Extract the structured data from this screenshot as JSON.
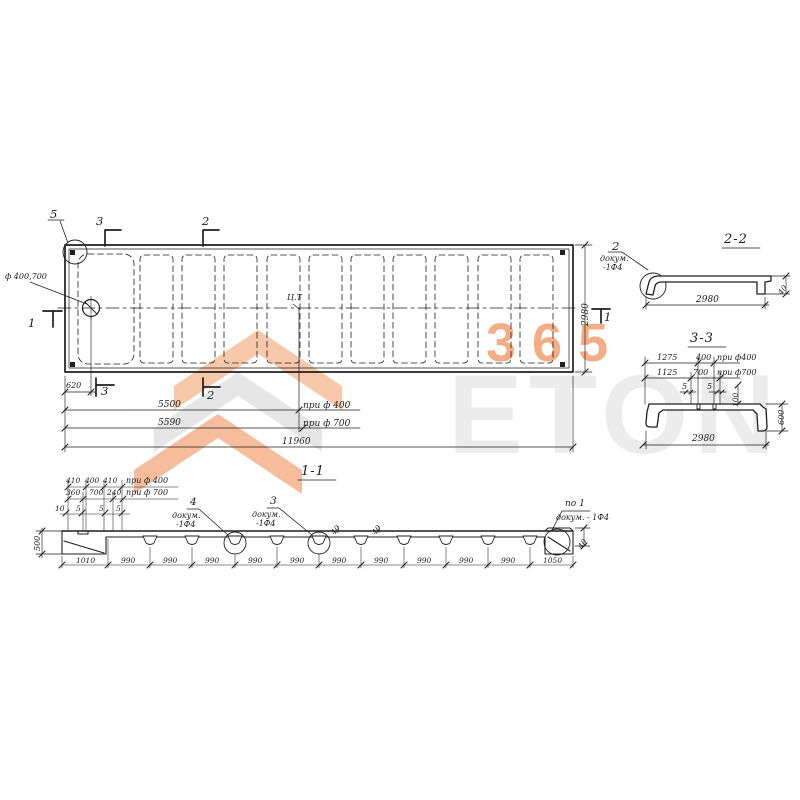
{
  "watermark": {
    "big_text": "ETON",
    "accent_text": "365",
    "accent_color": "#ee7b3a",
    "gray_color": "#ececec"
  },
  "plan": {
    "detail_callout": "5",
    "hole_label": "ф 400,700",
    "cg_label": "Ц.Т",
    "section_marks": {
      "m1_left": "1",
      "m1_right": "1",
      "m2_top": "2",
      "m2_bottom": "2",
      "m3_top": "3",
      "m3_bottom": "3"
    },
    "dims": {
      "hole_offset": "620",
      "to_cg_400": "5500",
      "to_cg_700": "5590",
      "length": "11960",
      "width": "2980",
      "note_400": "при ф 400",
      "note_700": "при ф 700"
    }
  },
  "section_2_2": {
    "title": "2-2",
    "callout": {
      "num": "2",
      "line1": "докум.",
      "line2": "-1Ф4"
    },
    "dims": {
      "width": "2980",
      "flange": "40"
    }
  },
  "section_3_3": {
    "title": "3-3",
    "dims": {
      "r1_a": "1275",
      "r1_b": "400",
      "r1_note": "при ф400",
      "r2_a": "1125",
      "r2_b": "700",
      "r2_note": "при ф700",
      "slot_a": "5",
      "slot_b": "5",
      "depth": "100",
      "height": "600",
      "width": "2980"
    }
  },
  "section_1_1": {
    "title": "1-1",
    "top_dims": {
      "a1": "410",
      "a2": "400",
      "a3": "410",
      "a_note": "при ф 400",
      "b1": "360",
      "b2": "700",
      "b3": "240",
      "b_note": "при ф 700",
      "s1": "10",
      "s2": "5",
      "s3": "5",
      "s4": "5"
    },
    "height": "500",
    "callout_4": {
      "num": "4",
      "line1": "докум.",
      "line2": "-1Ф4"
    },
    "callout_3": {
      "num": "3",
      "line1": "докум.",
      "line2": "-1Ф4"
    },
    "callout_r": {
      "num": "по 1",
      "line1": "докум. - 1Ф4"
    },
    "flange_thk": [
      "40",
      "40",
      "40"
    ],
    "bottom_dims": [
      "1010",
      "990",
      "990",
      "990",
      "990",
      "990",
      "990",
      "990",
      "990",
      "990",
      "990",
      "1050"
    ]
  }
}
